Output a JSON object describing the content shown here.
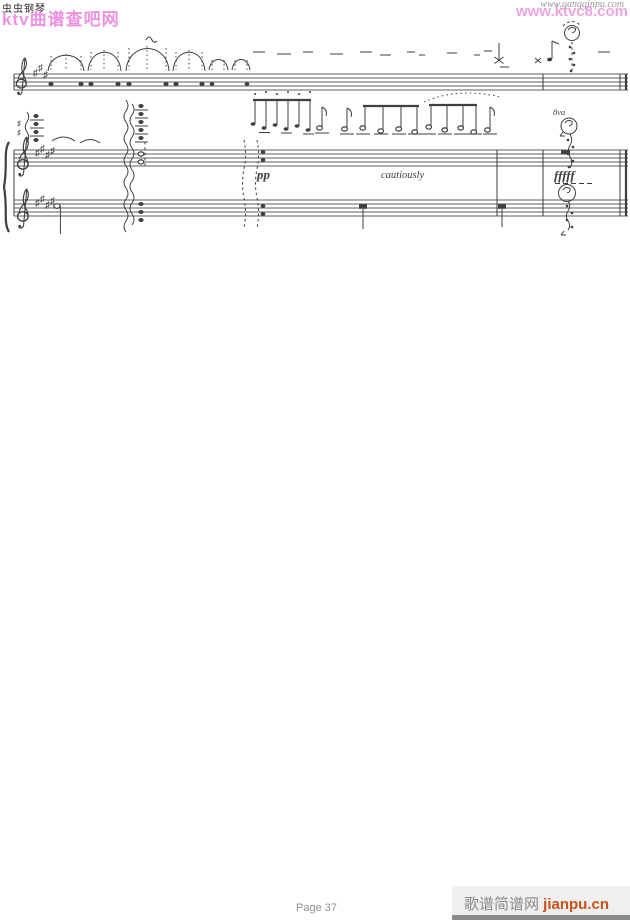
{
  "page": {
    "width": 630,
    "height": 920,
    "background": "#ffffff"
  },
  "watermarks": {
    "top_left_title": "虫虫钢琴",
    "top_left_site": "ktv曲谱查吧网",
    "top_right_site_gray": "www.gangqinpu.com",
    "top_right_site_pink": "www.ktvc8.com",
    "bottom_page_label": "Page 37",
    "bottom_right_site_name": "歌谱简谱网 ",
    "bottom_right_site_domain": "jianpu.cn"
  },
  "colors": {
    "pink_watermark": "#ec87dd",
    "gray_watermark": "#9a9a9a",
    "footer_gray": "#8f8f8f",
    "jianpu_orange": "#cc4f1a",
    "score_ink": "#3f3f3f"
  },
  "score": {
    "glyphs": {
      "sharp": "♯"
    },
    "octave_mark": "8va",
    "dynamics": {
      "pp": "pp",
      "expression": "cautiously",
      "fff": "fffff"
    }
  }
}
